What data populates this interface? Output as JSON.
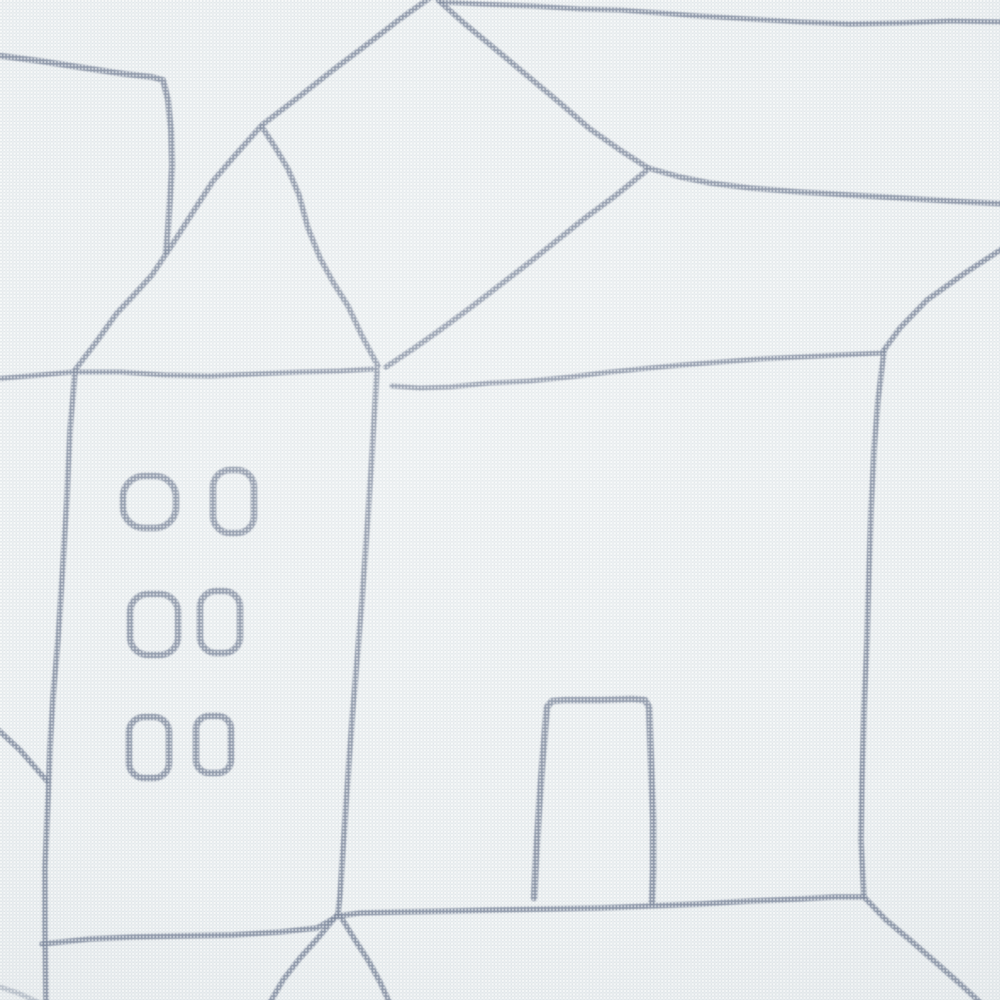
{
  "scene": {
    "kind": "close-up photograph of printed canvas fabric",
    "motif": "hand-drawn line art of houses",
    "palette": {
      "fabric_base": "#dfe5e8",
      "weave_light": "#f5f7f7",
      "weave_mid": "#ecf0f2",
      "line_ink": "#828da1",
      "vignette_shadow": "#8a96a4"
    }
  },
  "drawing": {
    "viewbox": "0 0 1000 1000",
    "stroke_color": "#828da1",
    "default_width": 5.5,
    "default_opacity": 0.85,
    "blur": 0.8,
    "elements": [
      {
        "name": "left-chimney-outline",
        "w": 6,
        "pts": [
          [
            -6,
            55
          ],
          [
            40,
            61
          ],
          [
            85,
            68
          ],
          [
            125,
            74
          ],
          [
            152,
            77
          ],
          [
            163,
            80
          ],
          [
            168,
            100
          ],
          [
            171,
            130
          ],
          [
            172,
            165
          ],
          [
            170,
            200
          ],
          [
            168,
            228
          ],
          [
            166,
            252
          ]
        ]
      },
      {
        "name": "left-house-ridge-and-left-roof-slope",
        "w": 5.5,
        "pts": [
          [
            434,
            -5
          ],
          [
            400,
            19
          ],
          [
            365,
            46
          ],
          [
            333,
            70
          ],
          [
            300,
            96
          ],
          [
            262,
            125
          ],
          [
            238,
            152
          ],
          [
            213,
            181
          ],
          [
            193,
            212
          ],
          [
            172,
            245
          ],
          [
            152,
            275
          ],
          [
            133,
            296
          ],
          [
            117,
            313
          ],
          [
            97,
            341
          ],
          [
            75,
            370
          ]
        ]
      },
      {
        "name": "left-house-right-roof-slope",
        "w": 5.5,
        "pts": [
          [
            262,
            127
          ],
          [
            275,
            147
          ],
          [
            288,
            169
          ],
          [
            299,
            195
          ],
          [
            308,
            228
          ],
          [
            320,
            258
          ],
          [
            333,
            282
          ],
          [
            348,
            306
          ],
          [
            362,
            336
          ],
          [
            378,
            366
          ]
        ]
      },
      {
        "name": "left-house-eave-line",
        "w": 5,
        "pts": [
          [
            -6,
            379
          ],
          [
            40,
            375
          ],
          [
            73,
            372
          ],
          [
            120,
            372
          ],
          [
            165,
            375
          ],
          [
            210,
            376
          ],
          [
            255,
            374
          ],
          [
            300,
            372
          ],
          [
            340,
            371
          ],
          [
            374,
            369
          ]
        ]
      },
      {
        "name": "center-wall-line",
        "w": 5.5,
        "pts": [
          [
            377,
            371
          ],
          [
            374,
            420
          ],
          [
            371,
            470
          ],
          [
            367,
            530
          ],
          [
            362,
            600
          ],
          [
            357,
            660
          ],
          [
            352,
            720
          ],
          [
            347,
            790
          ],
          [
            343,
            850
          ],
          [
            340,
            895
          ],
          [
            338,
            914
          ]
        ]
      },
      {
        "name": "big-roof-left-ridge",
        "w": 5.5,
        "pts": [
          [
            438,
            0
          ],
          [
            465,
            24
          ],
          [
            500,
            53
          ],
          [
            530,
            78
          ],
          [
            560,
            103
          ],
          [
            590,
            129
          ],
          [
            620,
            150
          ],
          [
            648,
            168
          ]
        ]
      },
      {
        "name": "big-roof-top-ridge",
        "w": 5.5,
        "pts": [
          [
            648,
            168
          ],
          [
            680,
            177
          ],
          [
            710,
            183
          ],
          [
            750,
            188
          ],
          [
            800,
            192
          ],
          [
            850,
            195
          ],
          [
            900,
            198
          ],
          [
            950,
            201
          ],
          [
            1006,
            204
          ]
        ]
      },
      {
        "name": "big-roof-left-edge",
        "w": 5.5,
        "pts": [
          [
            646,
            171
          ],
          [
            615,
            196
          ],
          [
            585,
            218
          ],
          [
            560,
            238
          ],
          [
            530,
            262
          ],
          [
            500,
            285
          ],
          [
            470,
            308
          ],
          [
            440,
            330
          ],
          [
            413,
            349
          ],
          [
            386,
            367
          ]
        ]
      },
      {
        "name": "top-horizon-line",
        "w": 5,
        "pts": [
          [
            440,
            2
          ],
          [
            480,
            4
          ],
          [
            533,
            6
          ],
          [
            580,
            9
          ],
          [
            620,
            10
          ],
          [
            660,
            13
          ],
          [
            700,
            16
          ],
          [
            750,
            19
          ],
          [
            800,
            22
          ],
          [
            850,
            24
          ],
          [
            900,
            23
          ],
          [
            950,
            21
          ],
          [
            1006,
            22
          ]
        ]
      },
      {
        "name": "big-roof-front-eave",
        "w": 5,
        "pts": [
          [
            392,
            386
          ],
          [
            420,
            388
          ],
          [
            450,
            387
          ],
          [
            490,
            383
          ],
          [
            530,
            381
          ],
          [
            570,
            377
          ],
          [
            610,
            372
          ],
          [
            650,
            368
          ],
          [
            682,
            365
          ],
          [
            720,
            362
          ],
          [
            760,
            359
          ],
          [
            800,
            357
          ],
          [
            840,
            355
          ],
          [
            882,
            353
          ]
        ]
      },
      {
        "name": "big-roof-right-edge",
        "w": 5.5,
        "pts": [
          [
            1005,
            247
          ],
          [
            965,
            273
          ],
          [
            927,
            300
          ],
          [
            900,
            328
          ],
          [
            884,
            350
          ]
        ]
      },
      {
        "name": "right-wall-line",
        "w": 5.5,
        "pts": [
          [
            884,
            351
          ],
          [
            878,
            400
          ],
          [
            874,
            450
          ],
          [
            871,
            510
          ],
          [
            869,
            570
          ],
          [
            867,
            640
          ],
          [
            864,
            710
          ],
          [
            862,
            780
          ],
          [
            861,
            840
          ],
          [
            863,
            880
          ],
          [
            864,
            897
          ]
        ]
      },
      {
        "name": "ground-line",
        "w": 5.5,
        "pts": [
          [
            42,
            944
          ],
          [
            90,
            939
          ],
          [
            133,
            937
          ],
          [
            180,
            936
          ],
          [
            233,
            935
          ],
          [
            280,
            932
          ],
          [
            317,
            928
          ],
          [
            338,
            916
          ],
          [
            360,
            913
          ],
          [
            400,
            912
          ],
          [
            450,
            911
          ],
          [
            493,
            910
          ],
          [
            550,
            909
          ],
          [
            600,
            908
          ],
          [
            650,
            906
          ],
          [
            700,
            904
          ],
          [
            750,
            901
          ],
          [
            800,
            899
          ],
          [
            835,
            897
          ],
          [
            862,
            897
          ]
        ]
      },
      {
        "name": "left-wall-line",
        "w": 5.5,
        "pts": [
          [
            75,
            372
          ],
          [
            70,
            430
          ],
          [
            67,
            497
          ],
          [
            63,
            563
          ],
          [
            58,
            640
          ],
          [
            53,
            697
          ],
          [
            50,
            747
          ],
          [
            48,
            800
          ],
          [
            45,
            867
          ],
          [
            45,
            930
          ],
          [
            46,
            1006
          ]
        ]
      },
      {
        "name": "left-edge-roof-diagonal",
        "w": 5.5,
        "pts": [
          [
            -6,
            726
          ],
          [
            20,
            750
          ],
          [
            47,
            781
          ]
        ]
      },
      {
        "name": "bottom-house-left-roof-slope",
        "w": 5.5,
        "pts": [
          [
            337,
            915
          ],
          [
            318,
            938
          ],
          [
            300,
            958
          ],
          [
            283,
            980
          ],
          [
            268,
            1006
          ]
        ]
      },
      {
        "name": "bottom-house-right-roof-slope",
        "w": 5.5,
        "pts": [
          [
            341,
            917
          ],
          [
            355,
            940
          ],
          [
            368,
            960
          ],
          [
            380,
            982
          ],
          [
            391,
            1006
          ]
        ]
      },
      {
        "name": "bottom-right-roof-diagonal",
        "w": 5.5,
        "pts": [
          [
            864,
            897
          ],
          [
            886,
            920
          ],
          [
            910,
            940
          ],
          [
            933,
            960
          ],
          [
            958,
            982
          ],
          [
            984,
            1006
          ]
        ]
      },
      {
        "name": "bottom-left-corner-line",
        "w": 5,
        "opacity": 0.45,
        "pts": [
          [
            -6,
            985
          ],
          [
            18,
            993
          ],
          [
            42,
            1004
          ]
        ]
      },
      {
        "name": "door-outline",
        "w": 6.5,
        "pts": [
          [
            534,
            898
          ],
          [
            537,
            840
          ],
          [
            541,
            780
          ],
          [
            545,
            730
          ],
          [
            547,
            707
          ],
          [
            552,
            701
          ],
          [
            565,
            700
          ],
          [
            600,
            700
          ],
          [
            632,
            699
          ],
          [
            645,
            700
          ],
          [
            649,
            707
          ],
          [
            651,
            760
          ],
          [
            653,
            820
          ],
          [
            653,
            870
          ],
          [
            652,
            902
          ]
        ]
      }
    ],
    "windows": [
      {
        "name": "window-row1-left",
        "x": 123,
        "y": 476,
        "w": 53,
        "h": 52,
        "rx": 21
      },
      {
        "name": "window-row1-right",
        "x": 213,
        "y": 470,
        "w": 41,
        "h": 63,
        "rx": 17
      },
      {
        "name": "window-row2-left",
        "x": 130,
        "y": 594,
        "w": 48,
        "h": 61,
        "rx": 18
      },
      {
        "name": "window-row2-right",
        "x": 200,
        "y": 591,
        "w": 40,
        "h": 62,
        "rx": 16
      },
      {
        "name": "window-row3-left",
        "x": 129,
        "y": 717,
        "w": 40,
        "h": 61,
        "rx": 15
      },
      {
        "name": "window-row3-right",
        "x": 196,
        "y": 716,
        "w": 35,
        "h": 57,
        "rx": 13
      }
    ],
    "window_stroke_width": 6.5
  }
}
